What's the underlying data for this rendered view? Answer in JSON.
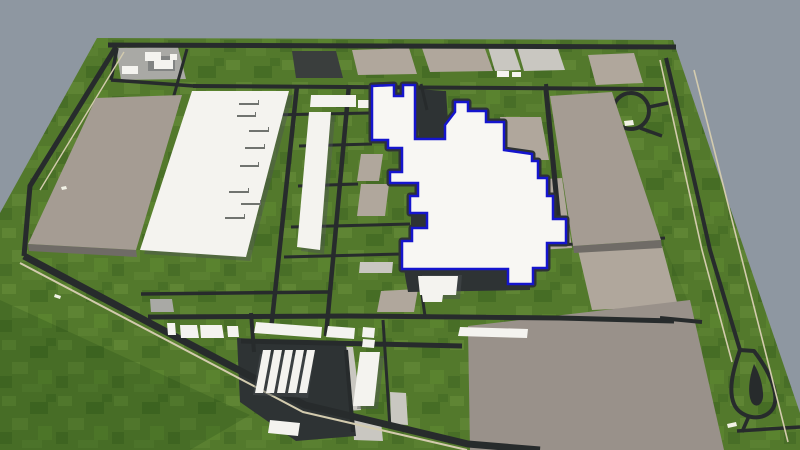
{
  "scene": {
    "app": "3d-site-viewer",
    "view": "aerial-perspective-site-plan",
    "selection": {
      "target": "central-production-hall",
      "state": "selected"
    }
  },
  "palette": {
    "sky": "#8e97a1",
    "grass": "#53792c",
    "road": "#272b2c",
    "lot": "#2e3334",
    "curb": "#d3cbae",
    "pad_taupe": "#b0a79c",
    "slab": "#a59c93",
    "paved": "#99918a",
    "pad_light": "#c9c7c1",
    "pad_charcoal": "#3a3e3d",
    "pad_concrete": "#a9a9a5",
    "building_white": "#f4f3ef",
    "unit_shadow": "#70736f",
    "side_face": "#6f6b66",
    "shadow": "#4e5356",
    "selection_fill": "#f8f7f3",
    "selection_stroke": "#1515cd",
    "marking": "#f2f2e6"
  }
}
